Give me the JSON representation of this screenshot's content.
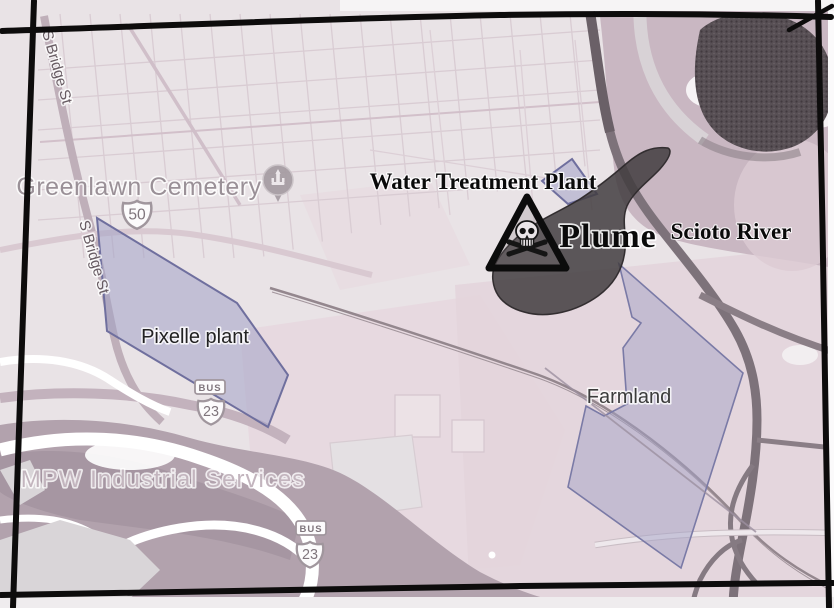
{
  "map": {
    "place_labels": {
      "greenlawn_cemetery": "Greenlawn Cemetery",
      "s_bridge_st": "S Bridge St",
      "pixelle_plant": "Pixelle plant",
      "mpw_industrial": "MPW Industrial Services",
      "farmland": "Farmland"
    },
    "annotations": {
      "water_treatment_plant": "Water Treatment Plant",
      "plume": "Plume",
      "scioto_river": "Scioto River"
    },
    "route_shields": {
      "us_50": "50",
      "us_23": "23",
      "bus": "BUS"
    },
    "colors": {
      "map_background": "#e9e3e6",
      "residential_pink": "#e4d4db",
      "river_mauve_dark": "#b2a2ad",
      "river_mauve_light": "#c9b7c2",
      "road_gray": "#7d727a",
      "overlay_polygon_fill": "#a3a2c6",
      "overlay_polygon_border": "#6f6f9e",
      "plume_fill": "#423d40",
      "frame_black": "#0d0c0c",
      "annotation_text": "#0a0a0a",
      "map_label_gray": "#9a9097"
    }
  }
}
